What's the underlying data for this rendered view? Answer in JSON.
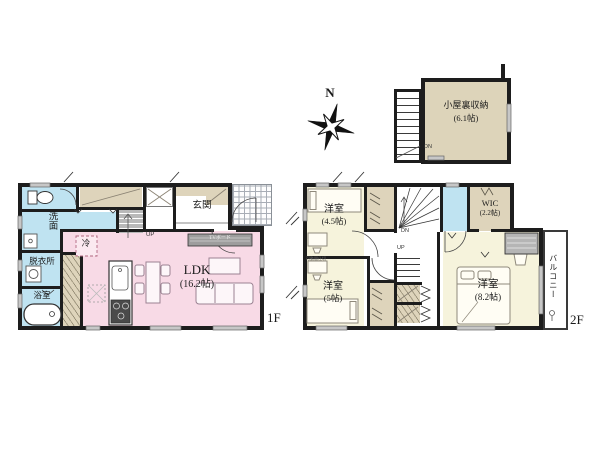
{
  "palette": {
    "wall": "#1d1d1d",
    "water_rooms": "#bfe3f1",
    "ldk": "#f8dae6",
    "bedrooms": "#f6f3dc",
    "closets": "#ded4bb",
    "attic": "#ddd4ba",
    "window": "#c7c7c7"
  },
  "compass": {
    "north_label": "N"
  },
  "attic": {
    "room_name": "小屋裏収納",
    "room_size": "(6.1帖)",
    "stairs_down_label": "DN"
  },
  "floor_1f": {
    "floor_label": "1F",
    "entrance_label": "玄関",
    "ldk_label": "LDK",
    "ldk_size": "(16.2帖)",
    "washroom_label": "洗面",
    "dressing_room_label": "脱衣所",
    "bathroom_label": "浴室",
    "refrigerator_label": "冷",
    "tv_board_label": "TVボード",
    "stairs_up_label": "UP"
  },
  "floor_2f": {
    "floor_label": "2F",
    "bedroom_45_label": "洋室",
    "bedroom_45_size": "(4.5帖)",
    "bedroom_5_label": "洋室",
    "bedroom_5_size": "(5帖)",
    "bedroom_82_label": "洋室",
    "bedroom_82_size": "(8.2帖)",
    "wic_label": "WIC",
    "wic_size": "(2.2帖)",
    "balcony_label": "バルコニー",
    "stairs_down_label": "DN",
    "stairs_up_label": "UP",
    "partition_note": "可動間仕切"
  }
}
